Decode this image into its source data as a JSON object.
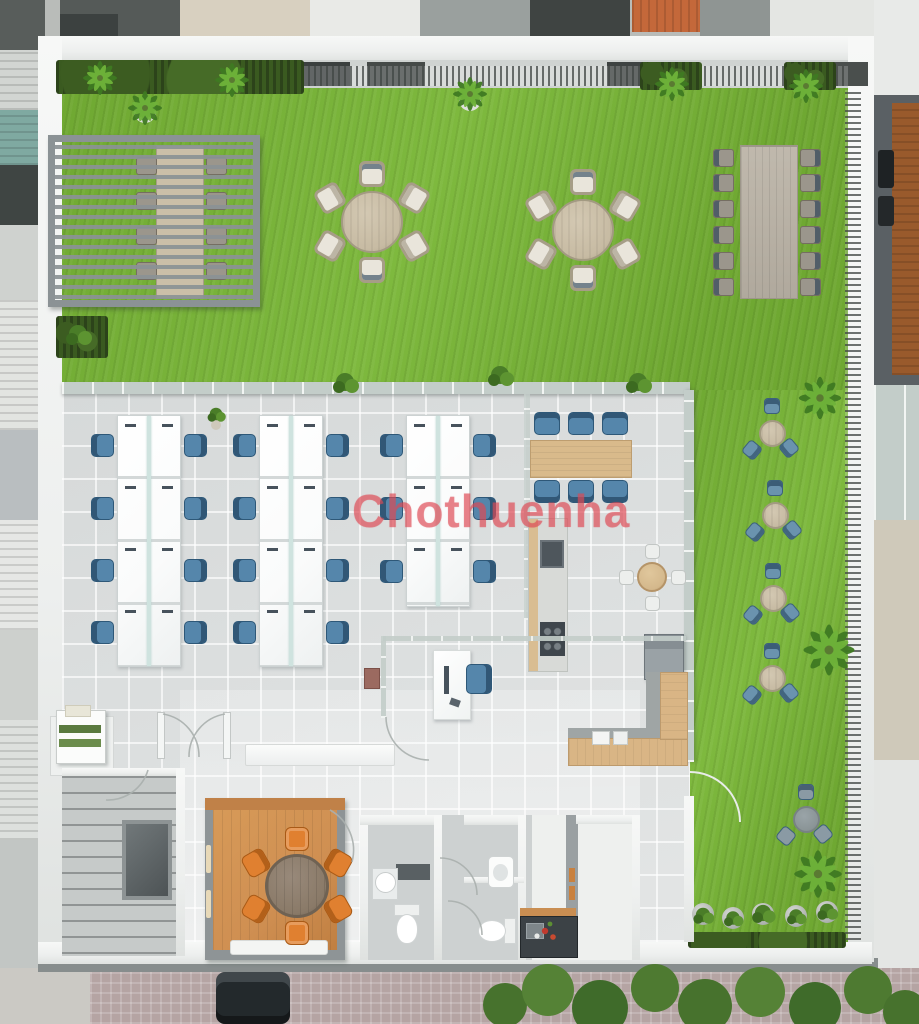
{
  "watermark": {
    "text": "Chothuenha"
  },
  "palette": {
    "grass": "#6fa832",
    "grass-light": "#7eb93e",
    "tile": "#dcdfdf",
    "parapet": "#edefee",
    "wall-gray": "#8e9496",
    "chair-blue": "#5586ab",
    "chair-orange": "#e08030",
    "chair-outdoor": "#e9e5db",
    "table-round": "#c7bba3",
    "desk": "#fafbfb",
    "wood-table": "#d9ba8b",
    "wood-counter": "#d9b585",
    "wood-floor": "#cf8f52",
    "pergola": "#8b9295",
    "street": "#b5a4a3",
    "tree": "#3f6b2a"
  },
  "scene_description": {
    "type": "3d-top-view-office-floorplan",
    "rooms": [
      "rooftop-garden",
      "open-office",
      "pantry",
      "manager-office",
      "meeting-room",
      "bathrooms",
      "kitchenette",
      "stairwell"
    ]
  }
}
